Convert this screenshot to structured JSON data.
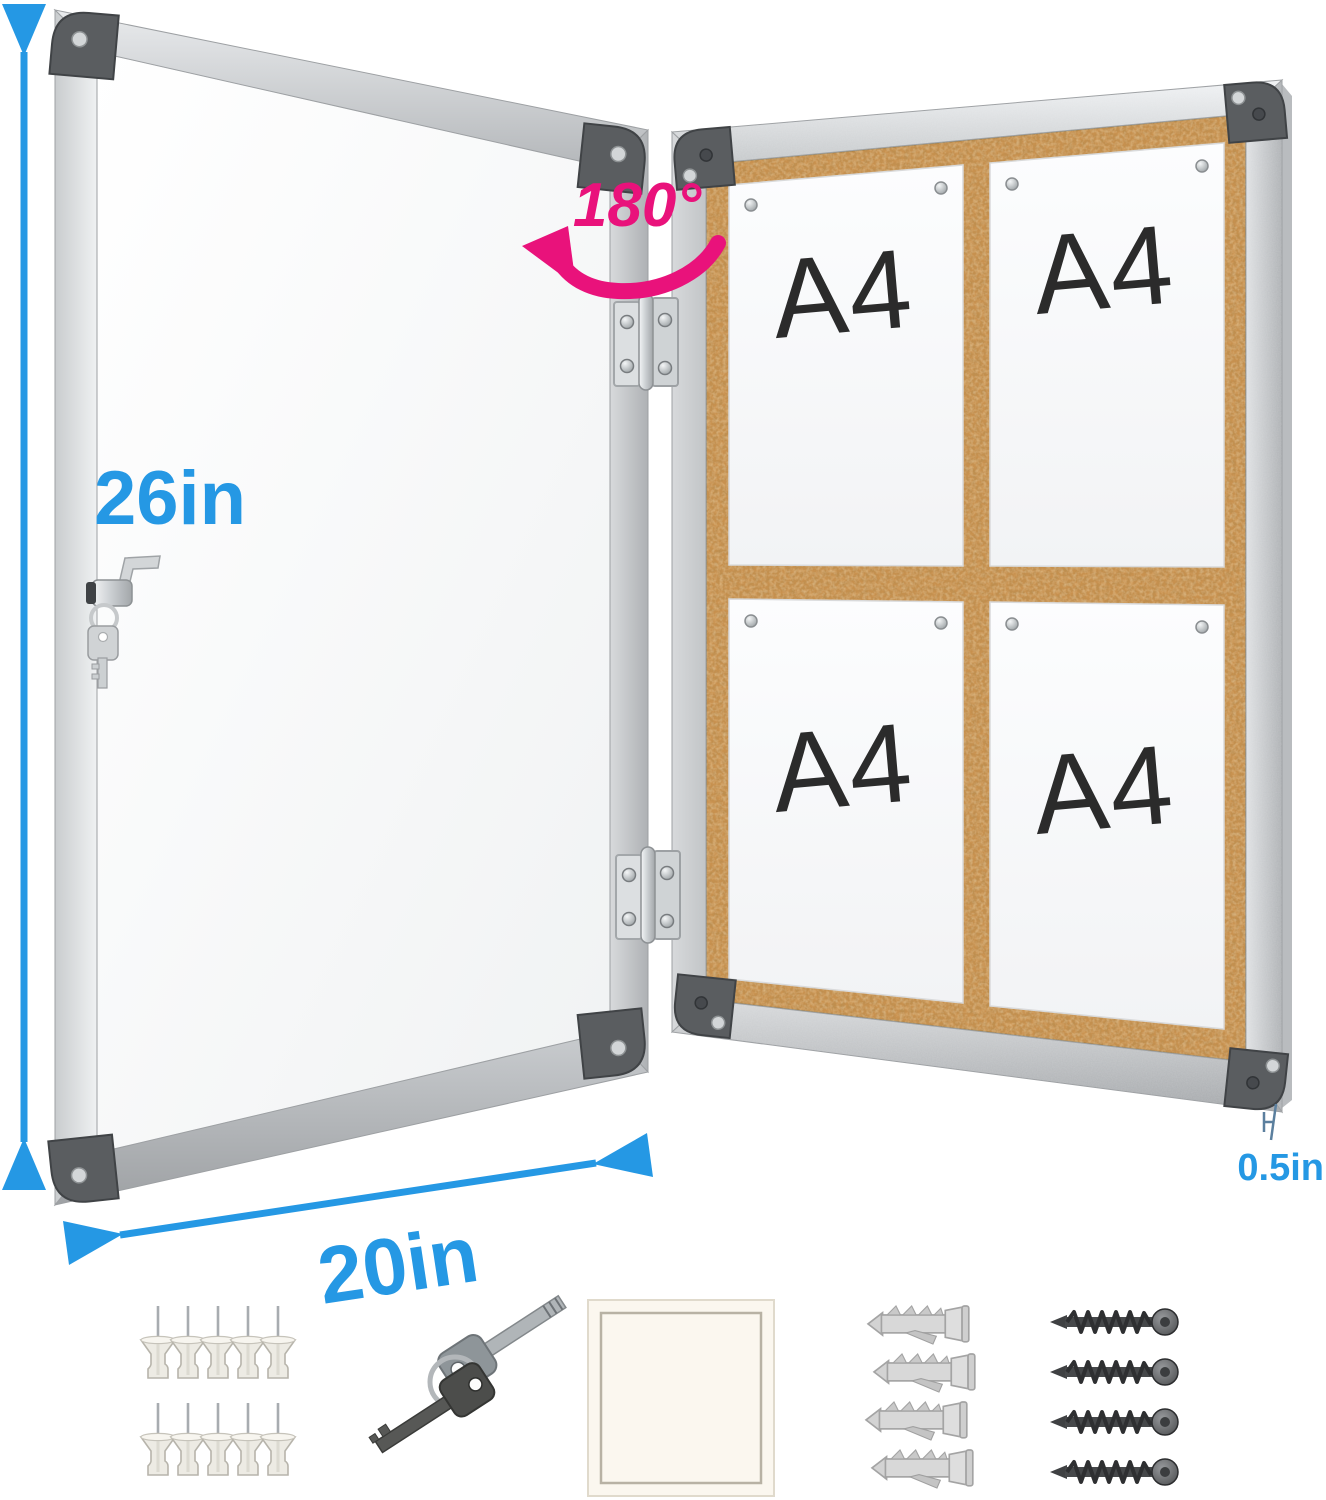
{
  "annotations": {
    "height_label": "26in",
    "width_label": "20in",
    "thickness_label": "0.5in",
    "rotation_label": "180°"
  },
  "board": {
    "paper_labels": [
      "A4",
      "A4",
      "A4",
      "A4"
    ]
  },
  "accessories": {
    "push_pins": {
      "icon": "push-pin-icon",
      "count": 10
    },
    "keys": {
      "icon": "key-icon",
      "count": 2
    },
    "note_pad": {
      "icon": "note-pad-icon",
      "count": 1
    },
    "wall_anchors": {
      "icon": "wall-anchor-icon",
      "count": 4
    },
    "screws": {
      "icon": "screw-icon",
      "count": 4
    }
  },
  "colors": {
    "dimension_blue": "#2598e4",
    "rotation_pink": "#e9127b",
    "cork_base": "#c8914f",
    "a4_text": "#2b2b2b",
    "thickness_mark": "#5b7f9e"
  }
}
